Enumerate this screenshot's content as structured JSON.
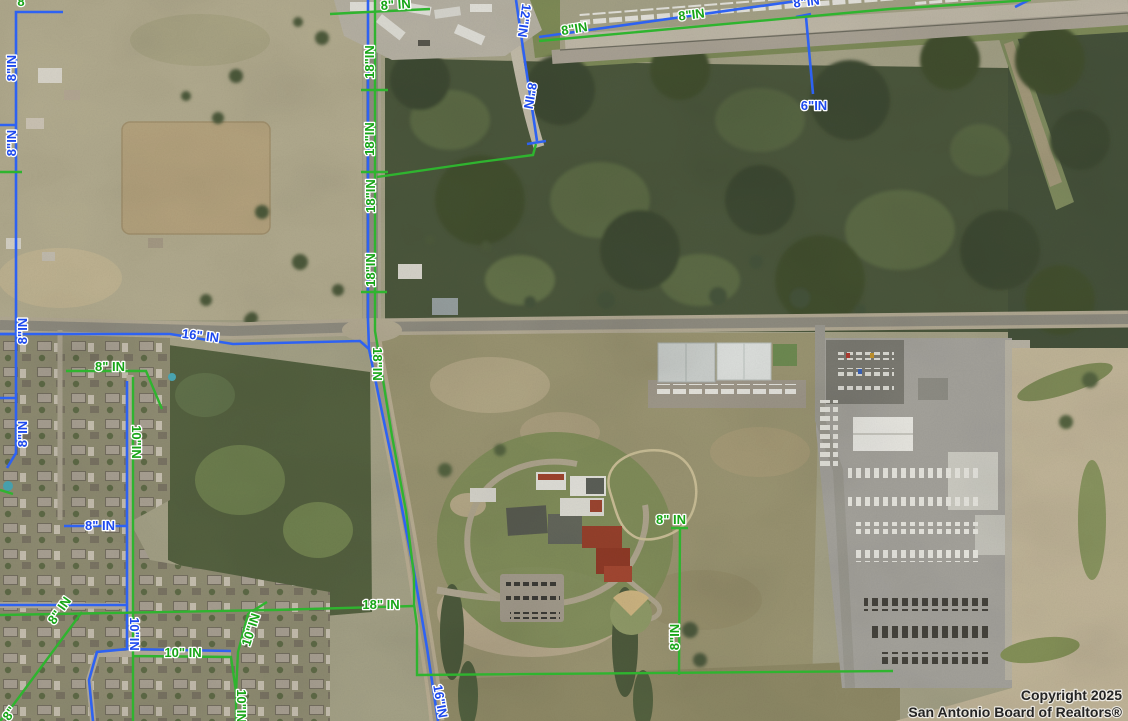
{
  "attribution": {
    "line1": "Copyright 2025",
    "line2": "San Antonio Board of Realtors®"
  },
  "colors": {
    "water_line": "#2e62f2",
    "sewer_line": "#2fb42f",
    "label_blue": "#1d49ee",
    "label_green": "#17a517"
  },
  "pipe_labels": [
    {
      "text": "8\"IN",
      "color": "blue",
      "x": 16,
      "y": 68,
      "rot": -90
    },
    {
      "text": "8\"IN",
      "color": "blue",
      "x": 16,
      "y": 143,
      "rot": -90
    },
    {
      "text": "8\"IN",
      "color": "blue",
      "x": 27,
      "y": 331,
      "rot": -90
    },
    {
      "text": "8\"IN",
      "color": "blue",
      "x": 27,
      "y": 434,
      "rot": -90
    },
    {
      "text": "8\" IN",
      "color": "blue",
      "x": 100,
      "y": 530,
      "rot": 0
    },
    {
      "text": "10\"IN",
      "color": "blue",
      "x": 130,
      "y": 634,
      "rot": 90
    },
    {
      "text": "16\" IN",
      "color": "blue",
      "x": 200,
      "y": 340,
      "rot": 7
    },
    {
      "text": "16\"IN",
      "color": "blue",
      "x": 436,
      "y": 702,
      "rot": 80
    },
    {
      "text": "12\"IN",
      "color": "blue",
      "x": 520,
      "y": 20,
      "rot": 98
    },
    {
      "text": "8\"IN",
      "color": "blue",
      "x": 526,
      "y": 95,
      "rot": 100
    },
    {
      "text": "8\"IN",
      "color": "blue",
      "x": 807,
      "y": 6,
      "rot": -7
    },
    {
      "text": "6\"IN",
      "color": "blue",
      "x": 814,
      "y": 110,
      "rot": 0
    },
    {
      "text": "8",
      "color": "green",
      "x": 21,
      "y": 6,
      "rot": 0
    },
    {
      "text": "8\" IN",
      "color": "green",
      "x": 396,
      "y": 9,
      "rot": -4
    },
    {
      "text": "18\"IN",
      "color": "green",
      "x": 374,
      "y": 62,
      "rot": -90
    },
    {
      "text": "18\"IN",
      "color": "green",
      "x": 374,
      "y": 139,
      "rot": -90
    },
    {
      "text": "18\"IN",
      "color": "green",
      "x": 375,
      "y": 196,
      "rot": -90
    },
    {
      "text": "18\"IN",
      "color": "green",
      "x": 375,
      "y": 270,
      "rot": -90
    },
    {
      "text": "18\"IN",
      "color": "green",
      "x": 373,
      "y": 364,
      "rot": 90
    },
    {
      "text": "8\"IN",
      "color": "green",
      "x": 575,
      "y": 33,
      "rot": -9
    },
    {
      "text": "8\"IN",
      "color": "green",
      "x": 692,
      "y": 19,
      "rot": -7
    },
    {
      "text": "8\" IN",
      "color": "green",
      "x": 110,
      "y": 371,
      "rot": 0
    },
    {
      "text": "10\"IN",
      "color": "green",
      "x": 132,
      "y": 442,
      "rot": 90
    },
    {
      "text": "8\" IN",
      "color": "green",
      "x": 63,
      "y": 613,
      "rot": -55
    },
    {
      "text": "10\" IN",
      "color": "green",
      "x": 183,
      "y": 657,
      "rot": 0
    },
    {
      "text": "10\"IN",
      "color": "green",
      "x": 255,
      "y": 631,
      "rot": -72
    },
    {
      "text": "10\"IN",
      "color": "green",
      "x": 237,
      "y": 706,
      "rot": 90
    },
    {
      "text": "18\" IN",
      "color": "green",
      "x": 381,
      "y": 609,
      "rot": 0
    },
    {
      "text": "8\" IN",
      "color": "green",
      "x": 671,
      "y": 524,
      "rot": 0
    },
    {
      "text": "8\"IN",
      "color": "green",
      "x": 679,
      "y": 637,
      "rot": -90
    },
    {
      "text": "8\"",
      "color": "green",
      "x": 13,
      "y": 716,
      "rot": -55
    }
  ]
}
